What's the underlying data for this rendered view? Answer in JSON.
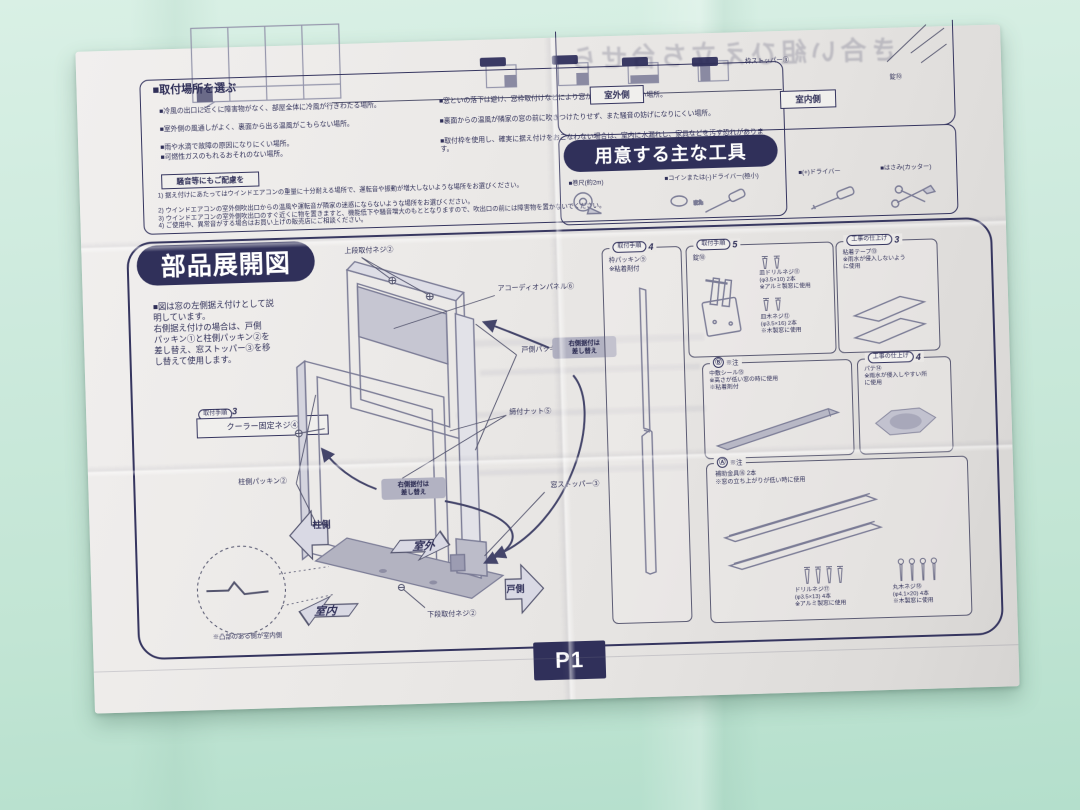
{
  "colors": {
    "accent_navy": "#30305a",
    "paper": "#ebe9e7",
    "background_green": "#c8e7d8",
    "diagram_gray": "#9596ac"
  },
  "page_label": "P1",
  "top_right": {
    "ghost_text": "き合い組ひえ立ち台せら",
    "outdoor": "室外側",
    "indoor": "室内側",
    "stopper": "枠ストッパー③",
    "lock": "錠⑩"
  },
  "location": {
    "title": "■取付場所を選ぶ",
    "bullets_left": [
      "■冷風の出口に近くに障害物がなく、部屋全体に冷風が行きわたる場所。",
      "■室外側の風通しがよく、裏面から出る温風がこもらない場所。",
      "■雨や水滴で故障の原因になりにくい場所。",
      "■可燃性ガスのもれるおそれのない場所。"
    ],
    "bullets_right": [
      "■窓といの落下は避け、窓枠取付けなどにより窓から本体が倒れない場所。",
      "■裏面からの温風が隣家の窓の前に吹きつけたりせず、また騒音の妨げになりにくい場所。",
      "■取付枠を使用し、確実に据え付けをおこなわない場合は、室内に水漏れし、家具などを汚す恐れがあります。"
    ],
    "notice_title": "騒音等にもご配慮を",
    "notes": [
      "1) 据え付けにあたってはウインドエアコンの重量に十分耐える場所で、運転音や振動が増大しないような場所をお選びください。",
      "2) ウインドエアコンの室外側吹出口からの温風や運転音が隣家の迷惑にならないような場所をお選びください。",
      "3) ウインドエアコンの室外側吹出口のすぐ近くに物を置きますと、機能低下や騒音増大のもととなりますので、吹出口の前には障害物を置かないでください。",
      "4) ご使用中、異常音がする場合はお買い上げの販売店にご相談ください。"
    ]
  },
  "tools": {
    "title": "用意する主な工具",
    "items": [
      {
        "label": "■巻尺(約2m)",
        "icon": "tape-measure-icon"
      },
      {
        "label": "■コインまたは(-)ドライバー(極小)",
        "icon": "coin-flat-screwdriver-icon"
      },
      {
        "label": "■(+)ドライバー",
        "icon": "phillips-screwdriver-icon"
      },
      {
        "label": "■はさみ(カッター)",
        "icon": "scissors-cutter-icon"
      }
    ]
  },
  "parts": {
    "title": "部品展開図",
    "intro": "■図は窓の左側据え付けとして説\n明しています。\n右側据え付けの場合は、戸側\nパッキン①と柱側パッキン②を\n差し替え、窓ストッパー③を移\nし替えて使用します。",
    "step3_badge": "取付手順",
    "step3_num": "3",
    "step3_item": "クーラー固定ネジ④",
    "labels": {
      "top_screw": "上段取付ネジ②",
      "accordion": "アコーディオンパネル⑥",
      "door_packing": "戸側パッキン①",
      "nut": "締付ナット⑤",
      "pillar_packing": "柱側パッキン②",
      "stopper": "窓ストッパー③",
      "bottom_screw": "下段取付ネジ②"
    },
    "swap_note": "右側据付は\n差し替え",
    "arrows": {
      "pillar": "柱側",
      "outdoor": "室外",
      "indoor": "室内",
      "door": "戸側"
    },
    "footnote": "※凸部のある側が室内側",
    "boxes": {
      "b1": {
        "badge": "取付手順",
        "num": "4",
        "body": "枠パッキン⑨\n※粘着剤付"
      },
      "b2": {
        "badge": "取付手順",
        "num": "5",
        "item": "錠⑩",
        "screw1": "皿ドリルネジ⑪\n(φ3.5×10) 2本\n※アルミ製窓に使用",
        "screw2": "皿木ネジ⑫\n(φ3.5×16) 2本\n※木製窓に使用"
      },
      "b3": {
        "badge": "工事の仕上げ",
        "num": "3",
        "body": "粘着テープ⑬\n※雨水が侵入しないよう\nに使用"
      },
      "b4": {
        "badge": "Ⓑ",
        "note": "※注",
        "body": "中敷シール⑮\n※高さが低い窓の時に使用\n※粘着剤付"
      },
      "b5": {
        "badge": "工事の仕上げ",
        "num": "4",
        "body": "パテ⑭\n※雨水が侵入しやすい所\nに使用"
      },
      "b6": {
        "badge": "Ⓐ",
        "note": "※注",
        "body": "補助金具⑯ 2本\n※窓の立ち上がりが低い時に使用",
        "screw1": "ドリルネジ⑰\n(φ3.5×13) 4本\n※アルミ製窓に使用",
        "screw2": "丸木ネジ⑱\n(φ4.1×20) 4本\n※木製窓に使用"
      }
    }
  }
}
